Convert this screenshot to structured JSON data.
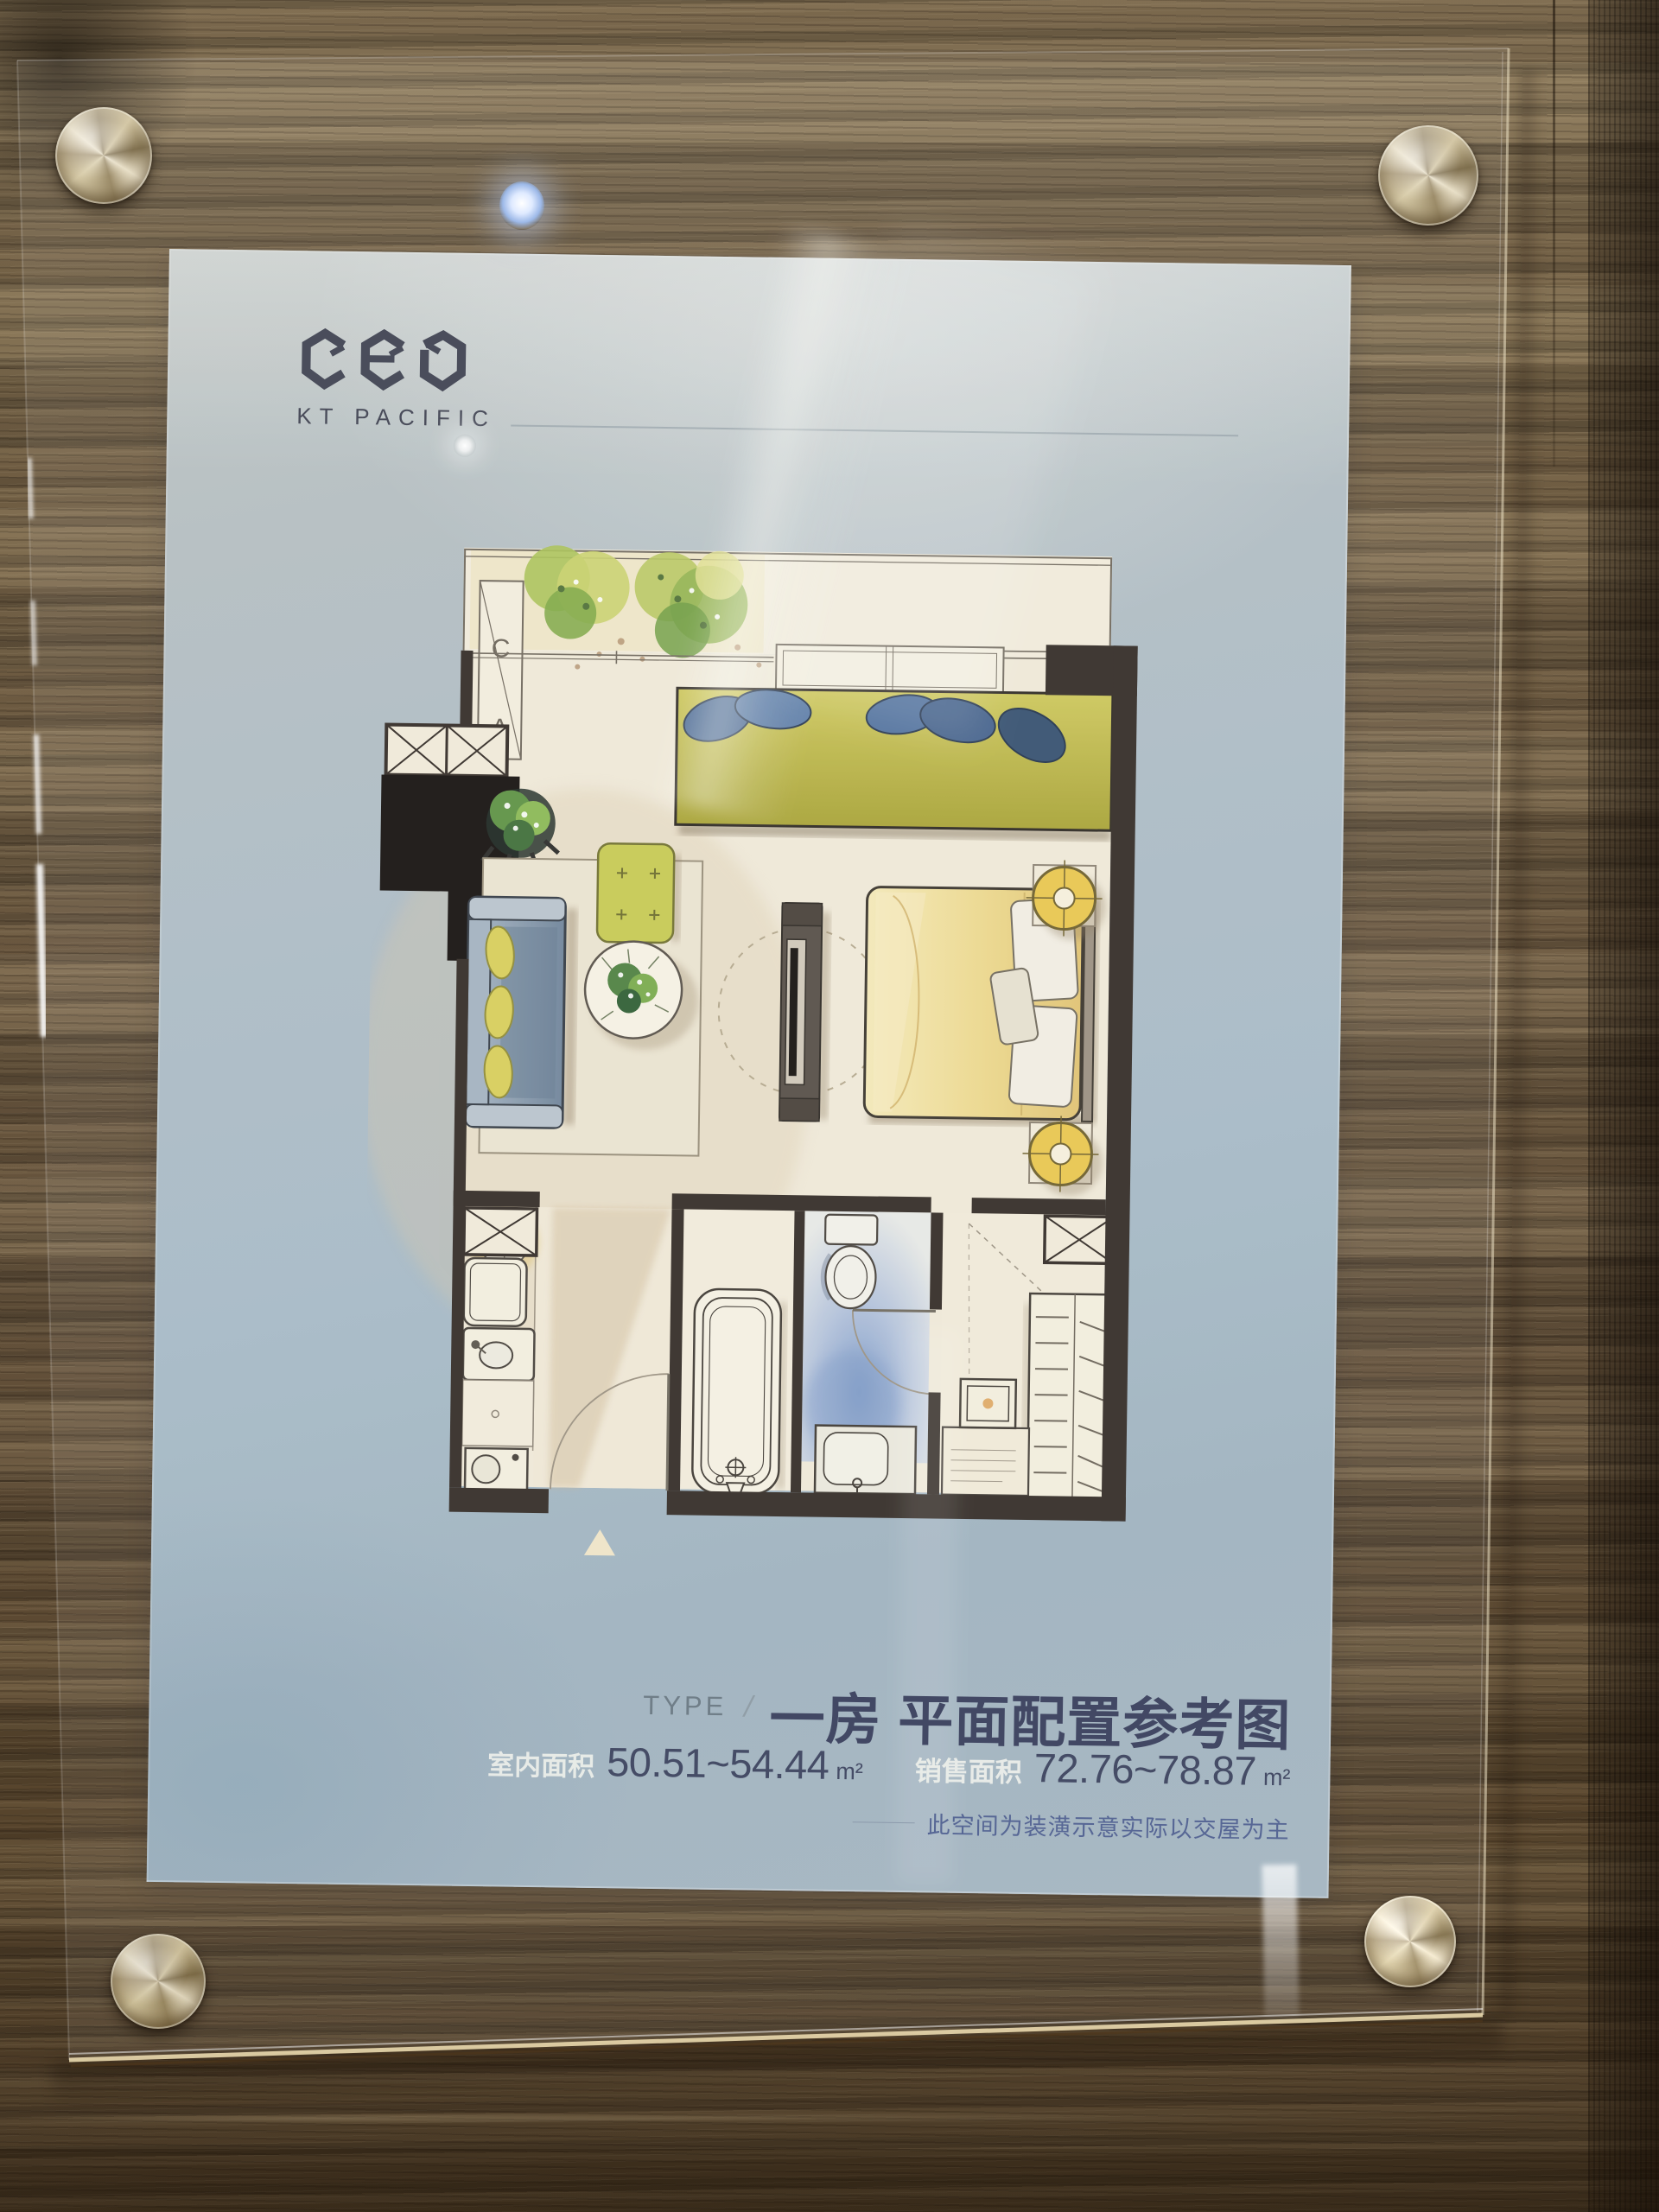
{
  "poster": {
    "brand": {
      "logo_word": "CEO",
      "logo_sub": "KT PACIFIC"
    },
    "type": {
      "label": "TYPE",
      "slash": "/",
      "title": "一房 平面配置参考图"
    },
    "areas": {
      "indoor": {
        "label": "室内面积",
        "value": "50.51~54.44",
        "unit": "m²"
      },
      "sales": {
        "label": "销售面积",
        "value": "72.76~78.87",
        "unit": "m²"
      }
    },
    "disclaimer": "此空间为装潢示意实际以交屋为主",
    "plan": {
      "ac_top": "C",
      "ac_bottom": "A"
    }
  },
  "colors": {
    "poster_bg": "#aabcc7",
    "title_navy": "#353c5a",
    "numbers_navy": "#39405c",
    "label_light": "#f1f3ed",
    "disclaimer_blue": "#4c5d8f",
    "wood_brown": "#73624a",
    "wall_dark": "#332c26",
    "paper_cream": "#f0ead9",
    "olive_green": "#c2bd4a",
    "sofa_blue": "#7e92a8",
    "bed_yellow": "#ecd88c",
    "bath_blue": "#8fa8cc",
    "lamp_yellow": "#e8c54e",
    "bolt_metal": "#cfc19c"
  }
}
